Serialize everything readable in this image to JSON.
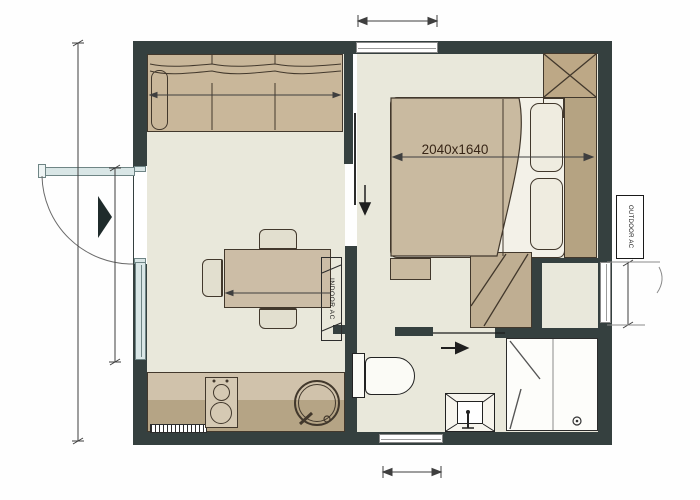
{
  "plan": {
    "type": "studio-apartment-floor-plan",
    "labels": {
      "bed_dimension": "2040x1640",
      "indoor_ac": "INDOOR AC",
      "outdoor_ac": "OUTDOOR AC"
    },
    "colors": {
      "wall": "#35403f",
      "floor": "#e9e8db",
      "furniture_tan": "#c9b79a",
      "furniture_dark_tan": "#b5a382",
      "window_glass": "#d9e6e6",
      "annotation_line": "#3f3f3f",
      "dimension_text": "#382617"
    },
    "rooms": [
      "living-area",
      "bedroom",
      "bathroom",
      "kitchenette"
    ],
    "furniture": [
      "sofa",
      "dining-table",
      "chairs",
      "kitchen-counter",
      "cooktop",
      "round-sink",
      "toilet",
      "washbasin",
      "shower-enclosure",
      "double-bed",
      "pillows",
      "wardrobe",
      "closet",
      "bench"
    ],
    "fixtures": [
      "entry-door",
      "bedroom-sliding-door",
      "bathroom-sliding-door",
      "window-top",
      "window-left",
      "window-right",
      "window-bottom",
      "indoor-ac-unit",
      "outdoor-ac-unit"
    ],
    "annotations": [
      "outer-dimension-lines",
      "bed-size-dimension",
      "entry-direction-marker",
      "flow-arrows"
    ]
  }
}
